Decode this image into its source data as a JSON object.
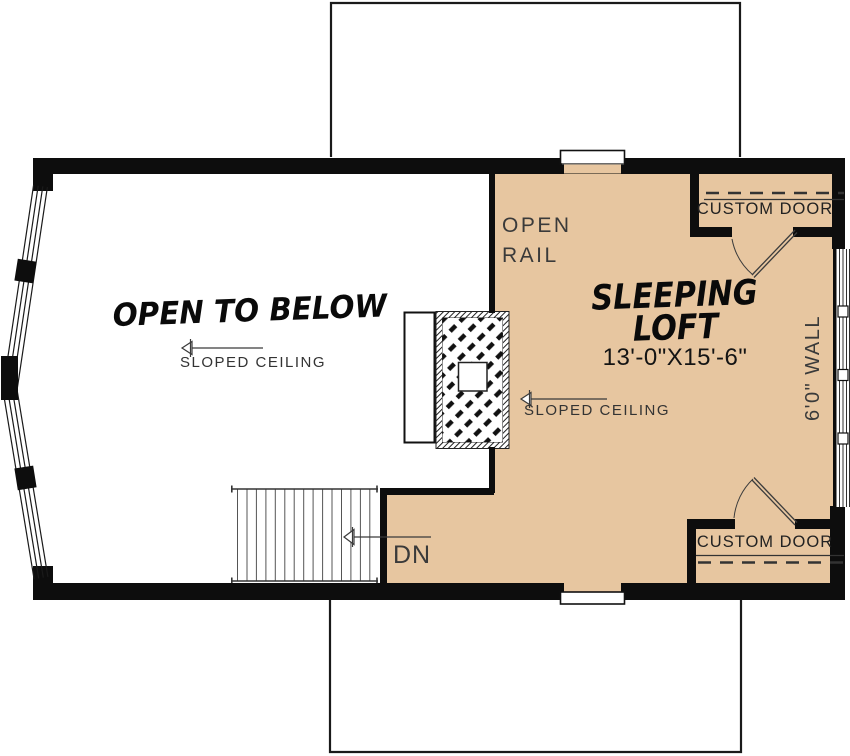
{
  "floor_plan": {
    "rooms": {
      "open_to_below": {
        "label": "OPEN TO BELOW",
        "ceiling_note": "SLOPED CEILING"
      },
      "sleeping_loft": {
        "name_line1": "SLEEPING",
        "name_line2": "LOFT",
        "dimensions": "13'-0\"X15'-6\"",
        "ceiling_note": "SLOPED CEILING"
      }
    },
    "annotations": {
      "open_rail_line1": "OPEN",
      "open_rail_line2": "RAIL",
      "custom_door_top": "CUSTOM DOOR",
      "custom_door_bottom": "CUSTOM DOOR",
      "wall_height": "6'0\" WALL",
      "stairs_direction": "DN"
    },
    "colors": {
      "loft_floor": "#e7c6a0",
      "walls": "#0d0d0d",
      "annotation_text": "#3a3a3a",
      "background": "#ffffff"
    }
  }
}
